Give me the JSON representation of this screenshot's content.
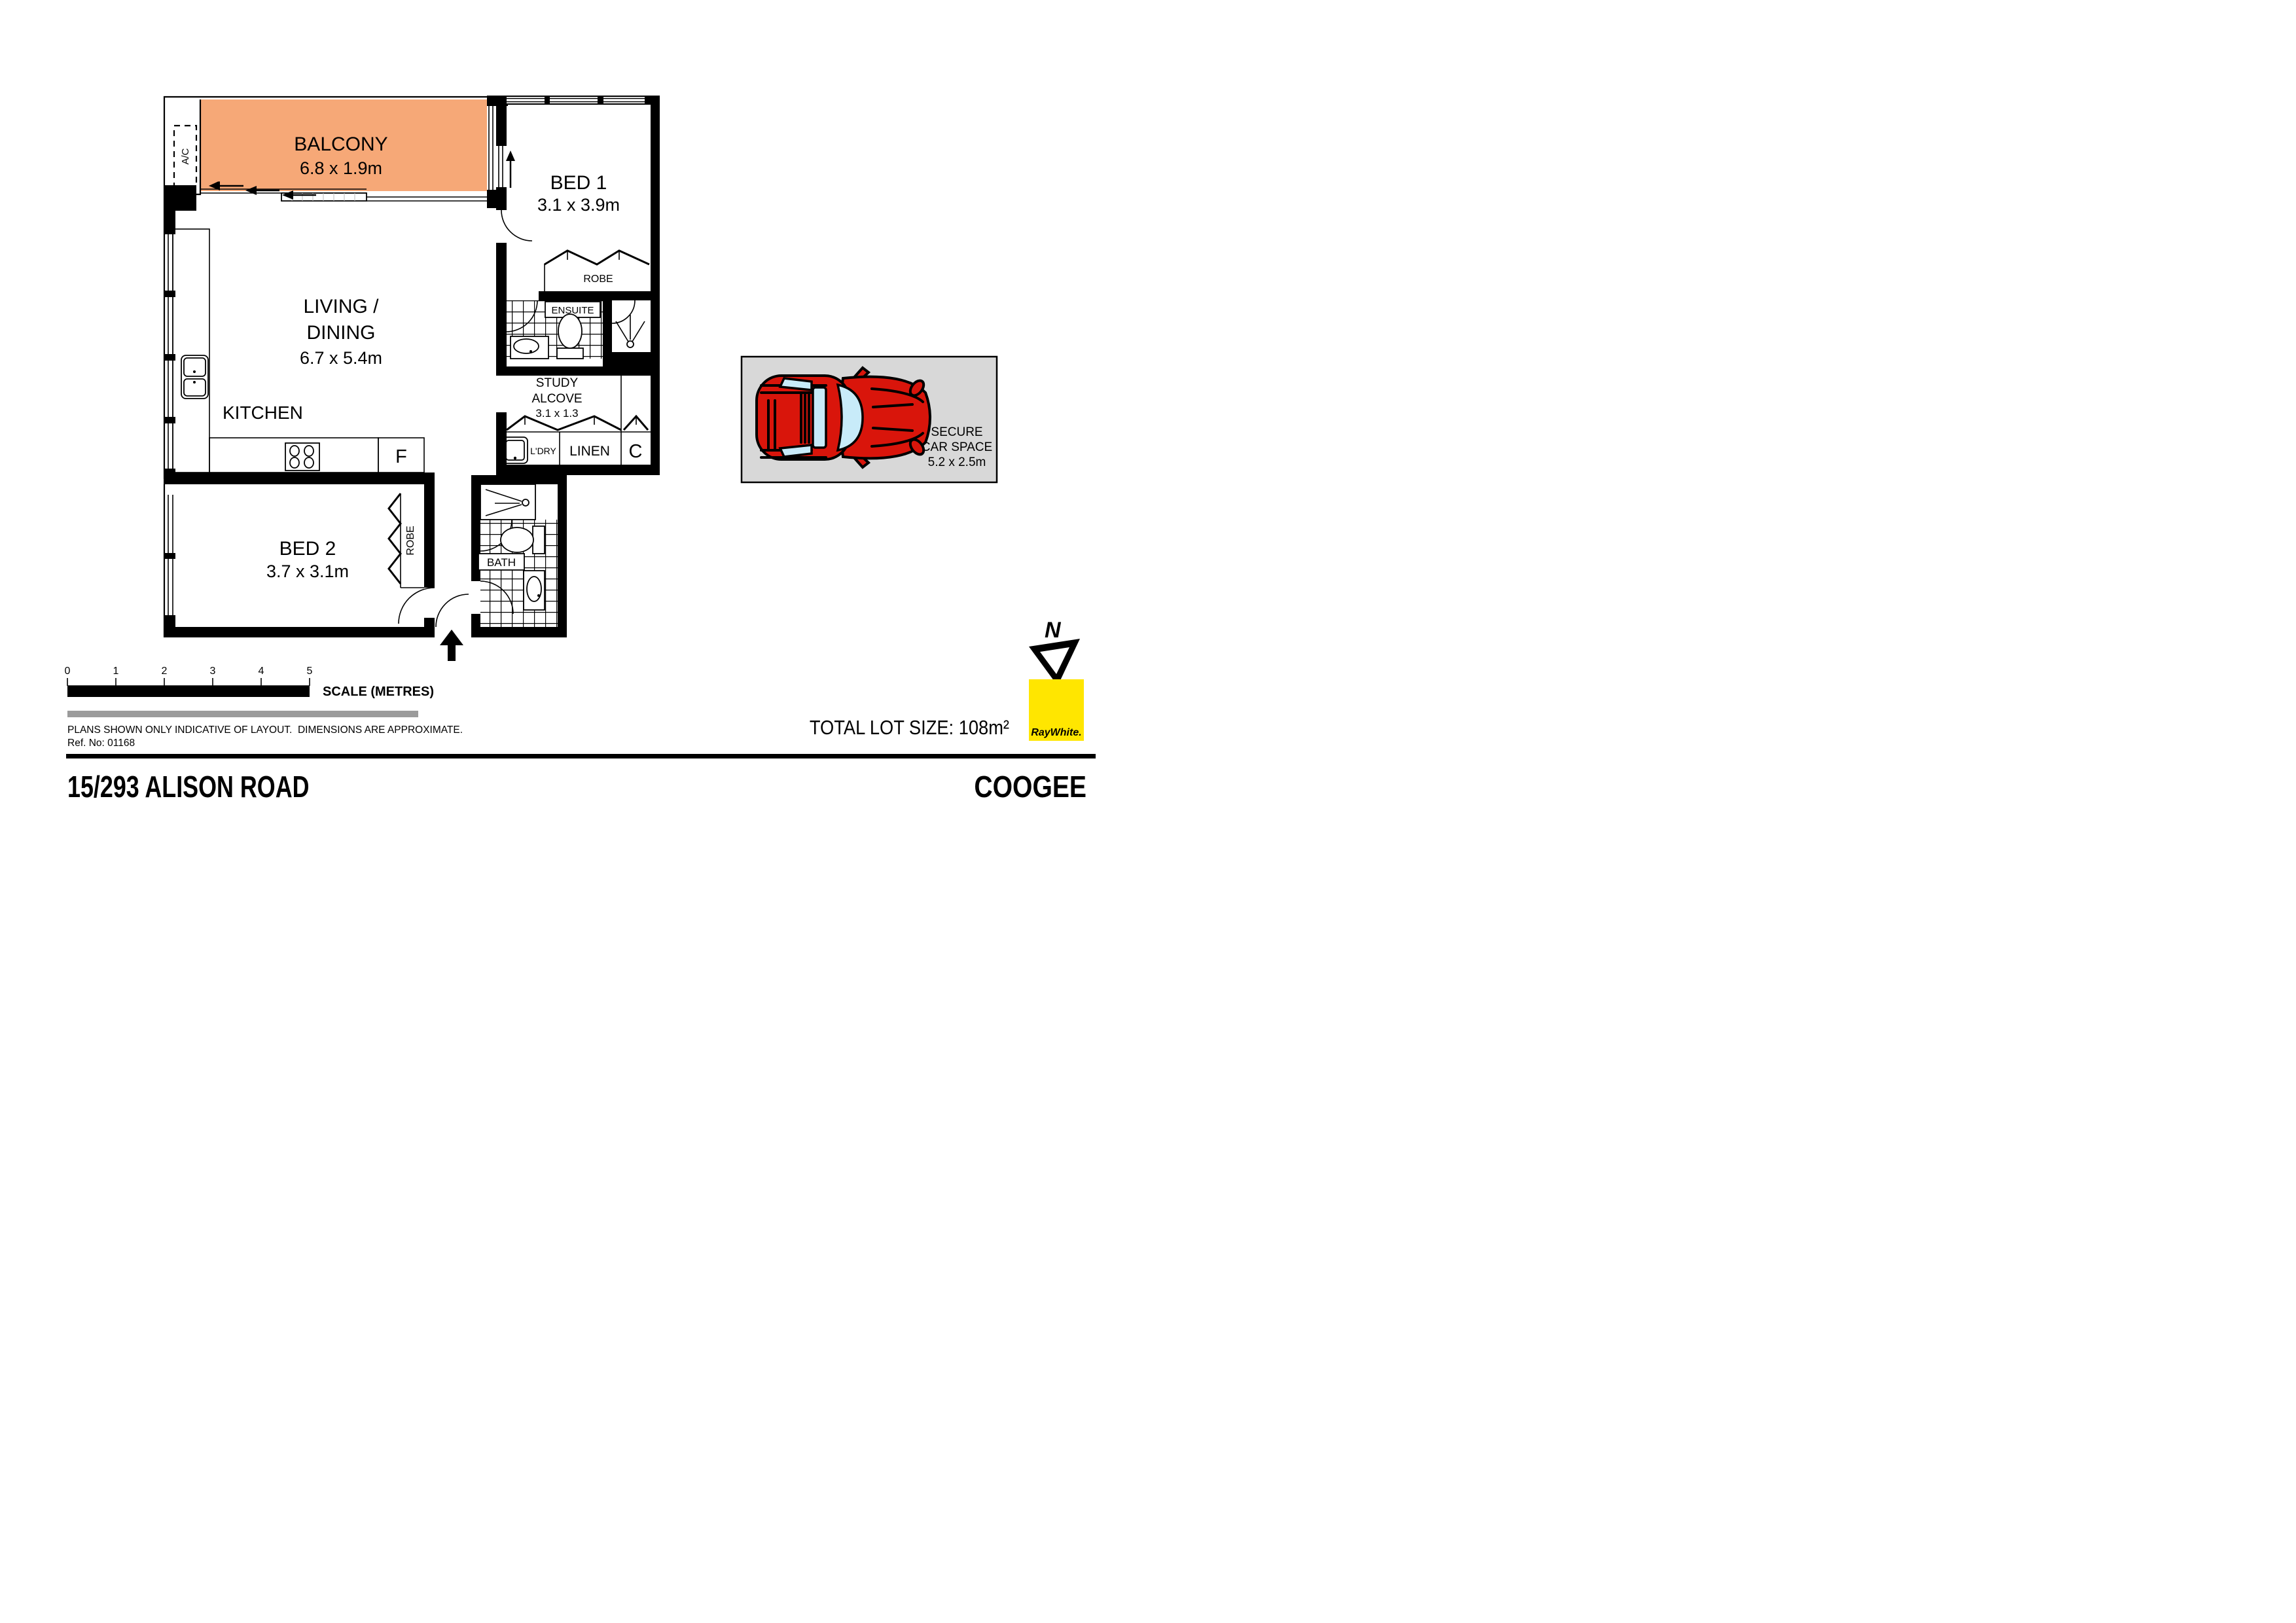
{
  "rooms": {
    "balcony": {
      "name": "BALCONY",
      "dims": "6.8 x 1.9m"
    },
    "bed1": {
      "name": "BED 1",
      "dims": "3.1 x 3.9m"
    },
    "living": {
      "line1": "LIVING /",
      "line2": "DINING",
      "dims": "6.7 x 5.4m"
    },
    "kitchen": {
      "name": "KITCHEN"
    },
    "bed2": {
      "name": "BED 2",
      "dims": "3.7 x 3.1m"
    },
    "study": {
      "line1": "STUDY",
      "line2": "ALCOVE",
      "dims": "3.1 x 1.3"
    },
    "ensuite": {
      "name": "ENSUITE"
    },
    "bath": {
      "name": "BATH"
    }
  },
  "fixtures": {
    "ac": "A/C",
    "robe_bed1": "ROBE",
    "robe_bed2": "ROBE",
    "laundry": "L'DRY",
    "linen": "LINEN",
    "cupboard": "C",
    "fridge": "F"
  },
  "car_space": {
    "line1": "SECURE",
    "line2": "CAR SPACE",
    "dims": "5.2 x 2.5m"
  },
  "north": {
    "label": "N"
  },
  "brand": {
    "logo_text": "RayWhite."
  },
  "scale_bar": {
    "ticks": [
      "0",
      "1",
      "2",
      "3",
      "4",
      "5"
    ],
    "label": "SCALE (METRES)"
  },
  "footer": {
    "disclaimer": "PLANS SHOWN ONLY INDICATIVE OF LAYOUT.  DIMENSIONS ARE APPROXIMATE.",
    "ref_no": "Ref. No: 01168",
    "total_lot_size": "TOTAL LOT SIZE: 108m²",
    "address": "15/293 ALISON ROAD",
    "suburb": "COOGEE"
  },
  "colors": {
    "balcony": "#F6A877",
    "carpark_bg": "#D8D8D8",
    "car_red": "#D9150B",
    "car_window": "#C8EBF9",
    "brand_yellow": "#FFE600",
    "brand_text": "#4A4A52",
    "scale_gray": "#9B9B9B"
  }
}
